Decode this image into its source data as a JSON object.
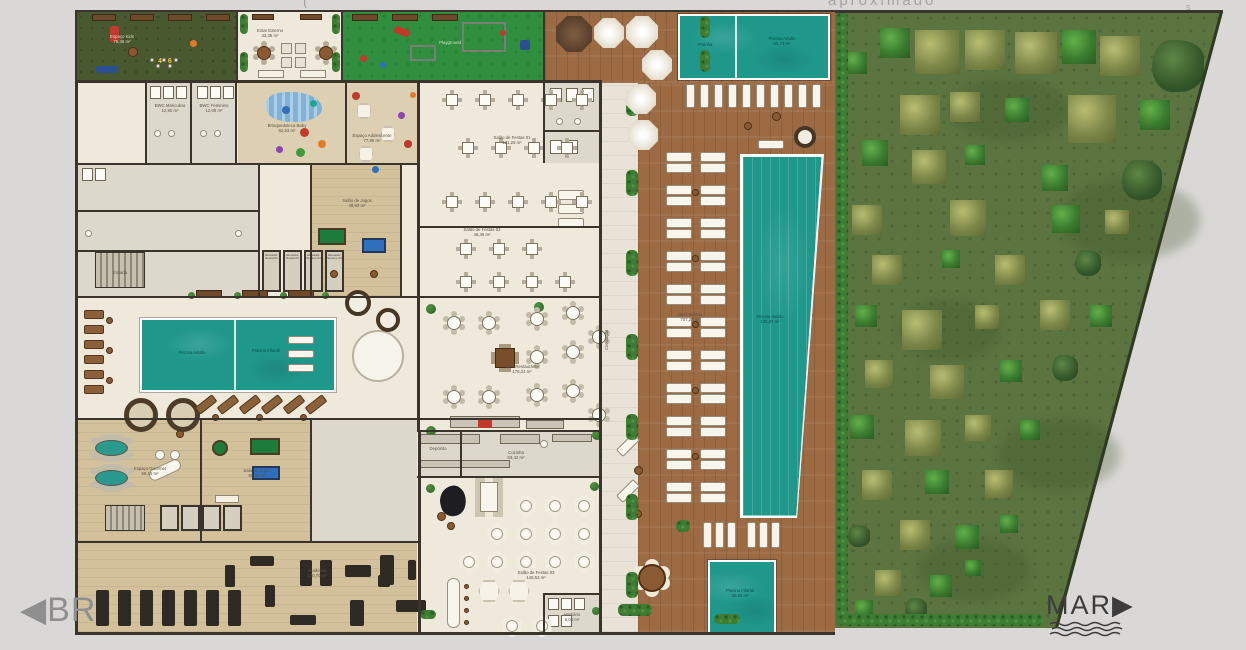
{
  "palette": {
    "background": "#d9d8d6",
    "deck_wood": "#9c6b44",
    "water": "#1f978b",
    "garden_lawn": "#5b7440",
    "kids_lawn": "#48592f",
    "playground_lawn": "#2f8f3e",
    "building_floor": "#efe9db",
    "wall": "#3a342c",
    "wood_room": "#d3c19c",
    "compass_br": "#8f8f8f",
    "compass_mar": "#3c3c3c"
  },
  "compass": {
    "br_label": "◀BR",
    "mar_label": "MAR▶"
  },
  "annotations": {
    "top_fragment": "aproximado",
    "top_mark": "s",
    "top_paren": "(",
    "kids_numbers": "4 6"
  },
  "rooms": [
    {
      "name": "Espaço Kids",
      "area": "75,36 m²"
    },
    {
      "name": "Estar Externo",
      "area": "43,35 m²"
    },
    {
      "name": "Playground",
      "area": ""
    },
    {
      "name": "Brinquedoteca Baby",
      "area": "62,53 m²"
    },
    {
      "name": "Espaço Adolescente",
      "area": "77,95 m²"
    },
    {
      "name": "Salão de Festas 01",
      "area": "121,29 m²"
    },
    {
      "name": "Salão de Festas 02",
      "area": "46,46 m²"
    },
    {
      "name": "Bar / Restaurante",
      "area": "175,31 m²"
    },
    {
      "name": "Cozinha",
      "area": "53,42 m²"
    },
    {
      "name": "Salão de Festas 03",
      "area": "145,52 m²"
    },
    {
      "name": "Academia",
      "area": "170,70 m²"
    },
    {
      "name": "Salão de Jogos",
      "area": "48,93 m²"
    },
    {
      "name": "Sala de Jogos",
      "area": "65,46 m²"
    },
    {
      "name": "Espaço Gourmet",
      "area": "59,10 m²"
    },
    {
      "name": "Circulação",
      "area": "29,75 m²"
    },
    {
      "name": "BWC Masculino",
      "area": "12,80 m²"
    },
    {
      "name": "BWC Feminino",
      "area": "12,08 m²"
    },
    {
      "name": "Escada",
      "area": ""
    },
    {
      "name": "Deck Solário",
      "area": "707,27 m²"
    },
    {
      "name": "Vestiário",
      "area": "6,04 m²"
    },
    {
      "name": "Depósito",
      "area": ""
    }
  ],
  "pools": {
    "top_left": {
      "name": "Prainha",
      "area": ""
    },
    "top_right": {
      "name": "Piscina Adulto",
      "area": "60,73 m²"
    },
    "lap": {
      "name": "Piscina Adulto",
      "area": "135,07 m²"
    },
    "kids_outdoor": {
      "name": "Piscina Infantil",
      "area": "20,84 m²"
    },
    "indoor_adult": {
      "name": "Piscina Adulto",
      "area": ""
    },
    "indoor_kids": {
      "name": "Piscina Infantil",
      "area": ""
    }
  },
  "elevators": [
    "Elevador Social 01",
    "Elevador Social 02",
    "Elevador Serviço 01",
    "Elevador Serviço 02"
  ]
}
